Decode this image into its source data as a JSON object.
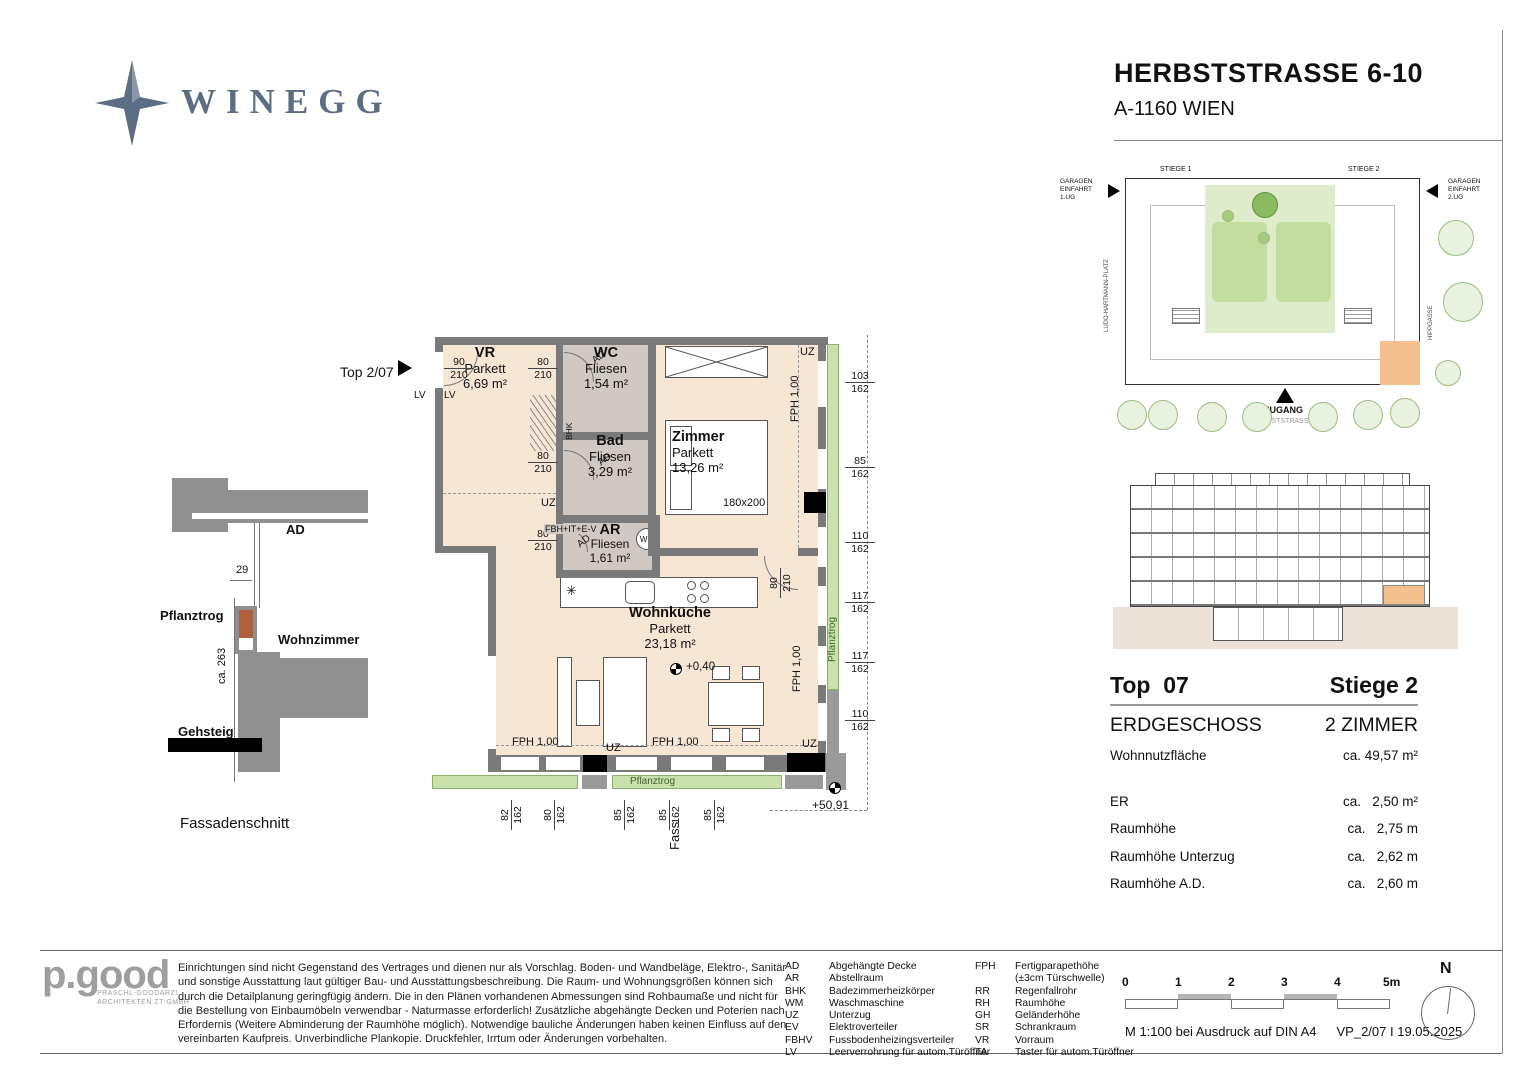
{
  "header": {
    "brand": "WINEGG",
    "title": "HERBSTSTRASSE 6-10",
    "subtitle": "A-1160 WIEN"
  },
  "colors": {
    "brand_blue": "#5d6e84",
    "floor_peach": "#f8e6d5",
    "tile_gray": "#cfc8c3",
    "wall_gray": "#7a7a7a",
    "accent_green": "#c9e2ab",
    "highlight_orange": "#f4c08e"
  },
  "floorplan": {
    "unit_label": "Top 2/07",
    "rooms": {
      "vr": {
        "name": "VR",
        "floor": "Parkett",
        "area": "6,69 m²"
      },
      "wc": {
        "name": "WC",
        "floor": "Fliesen",
        "area": "1,54 m²"
      },
      "bad": {
        "name": "Bad",
        "floor": "Fliesen",
        "area": "3,29 m²"
      },
      "zimmer": {
        "name": "Zimmer",
        "floor": "Parkett",
        "area": "13,26 m²"
      },
      "ar": {
        "name": "AR",
        "floor": "Fliesen",
        "area": "1,61 m²"
      },
      "kueche": {
        "name": "Wohnküche",
        "floor": "Parkett",
        "area": "23,18 m²"
      }
    },
    "labels": {
      "bed": "180x200",
      "level": "+0,40",
      "corner_level": "+50,91",
      "fass": "Fass",
      "pflanztrog_bottom": "Pflanztrog",
      "pflanztrog_right": "Pflanztrog",
      "uz": "UZ",
      "fph": "FPH 1,00",
      "fbh": "FBH+IT+E-V",
      "lv": "LV",
      "wm": "WM",
      "bhk": "BHK",
      "ad": "AD",
      "star": "✳"
    },
    "doors": {
      "entry": [
        "90",
        "210"
      ],
      "wc": [
        "80",
        "210"
      ],
      "bad": [
        "80",
        "210"
      ],
      "ar": [
        "80",
        "210"
      ],
      "zimmer": [
        "80",
        "210"
      ]
    },
    "dims_right": [
      [
        "103",
        "162"
      ],
      [
        "85",
        "162"
      ],
      [
        "110",
        "162"
      ],
      [
        "117",
        "162"
      ],
      [
        "117",
        "162"
      ],
      [
        "110",
        "162"
      ]
    ],
    "dims_bottom": [
      [
        "82",
        "162"
      ],
      [
        "80",
        "162"
      ],
      [
        "85",
        "162"
      ],
      [
        "85",
        "162"
      ],
      [
        "85",
        "162"
      ]
    ]
  },
  "fassade": {
    "title": "Fassadenschnitt",
    "ad": "AD",
    "pflanztrog": "Pflanztrog",
    "wohnzimmer": "Wohnzimmer",
    "gehsteig": "Gehsteig",
    "dim_width": "29",
    "dim_height": "ca. 263"
  },
  "siteplan": {
    "stiege1": "STIEGE 1",
    "stiege2": "STIEGE 2",
    "garage1": [
      "GARAGEN",
      "EINFAHRT",
      "1.UG"
    ],
    "garage2": [
      "GARAGEN",
      "EINFAHRT",
      "2.UG"
    ],
    "street_left": "LUDO-HARTMANN-PLATZ",
    "street_right": "HIPPGASSE",
    "zugang": "ZUGANG",
    "street_bottom": "HERBSTSTRASSE"
  },
  "unit_info": {
    "top": "Top  07",
    "stiege": "Stiege 2",
    "floor": "ERDGESCHOSS",
    "rooms": "2 ZIMMER",
    "rows": [
      {
        "label": "Wohnnutzfläche",
        "value": "ca. 49,57 m²"
      },
      {
        "label": "ER",
        "value": "ca.   2,50 m²"
      },
      {
        "label": "Raumhöhe",
        "value": "ca.   2,75 m"
      },
      {
        "label": "Raumhöhe Unterzug",
        "value": "ca.   2,62 m"
      },
      {
        "label": "Raumhöhe A.D.",
        "value": "ca.   2,60 m"
      }
    ]
  },
  "footer": {
    "architect": {
      "logo": "p.good",
      "line1": "PRASCHL-GOODARZI",
      "line2": "ARCHITEKTEN ZT-GMBH"
    },
    "disclaimer": "Einrichtungen sind nicht Gegenstand des Vertrages und dienen nur als Vorschlag. Boden- und Wandbeläge, Elektro-, Sanitär und sonstige Ausstattung laut gültiger Bau- und Ausstattungsbeschreibung. Die Raum- und Wohnungsgrößen können sich durch die Detailplanung geringfügig ändern. Die in den Plänen vorhandenen Abmessungen sind Rohbaumaße und nicht für die Bestellung von Einbaumöbeln verwendbar - Naturmasse erforderlich! Zusätzliche abgehängte Decken und Poterien nach Erfordernis (Weitere Abminderung der Raumhöhe möglich). Notwendige bauliche Änderungen haben keinen Einfluss auf den vereinbarten Kaufpreis. Unverbindliche Plankopie. Druckfehler, Irrtum oder Änderungen vorbehalten.",
    "legend_left": [
      {
        "abbr": "AD",
        "text": "Abgehängte Decke"
      },
      {
        "abbr": "AR",
        "text": "Abstellraum"
      },
      {
        "abbr": "BHK",
        "text": "Badezimmerheizkörper"
      },
      {
        "abbr": "WM",
        "text": "Waschmaschine"
      },
      {
        "abbr": "UZ",
        "text": "Unterzug"
      },
      {
        "abbr": "EV",
        "text": "Elektroverteiler"
      },
      {
        "abbr": "FBHV",
        "text": "Fussbodenheizingsverteiler"
      },
      {
        "abbr": "LV",
        "text": "Leerverrohrung für autom.Türöffner"
      }
    ],
    "legend_right": [
      {
        "abbr": "FPH",
        "text": "Fertigparapethöhe"
      },
      {
        "abbr": "",
        "text": "(±3cm Türschwelle)"
      },
      {
        "abbr": "RR",
        "text": "Regenfallrohr"
      },
      {
        "abbr": "RH",
        "text": "Raumhöhe"
      },
      {
        "abbr": "GH",
        "text": "Geländerhöhe"
      },
      {
        "abbr": "SR",
        "text": "Schrankraum"
      },
      {
        "abbr": "VR",
        "text": "Vorraum"
      },
      {
        "abbr": "TA",
        "text": "Taster für autom.Türöffner"
      }
    ],
    "scale": {
      "ticks": [
        "0",
        "1",
        "2",
        "3",
        "4",
        "5m"
      ],
      "note": "M 1:100 bei Ausdruck auf DIN A4",
      "ref": "VP_2/07 I 19.05.2025"
    },
    "north": "N"
  }
}
